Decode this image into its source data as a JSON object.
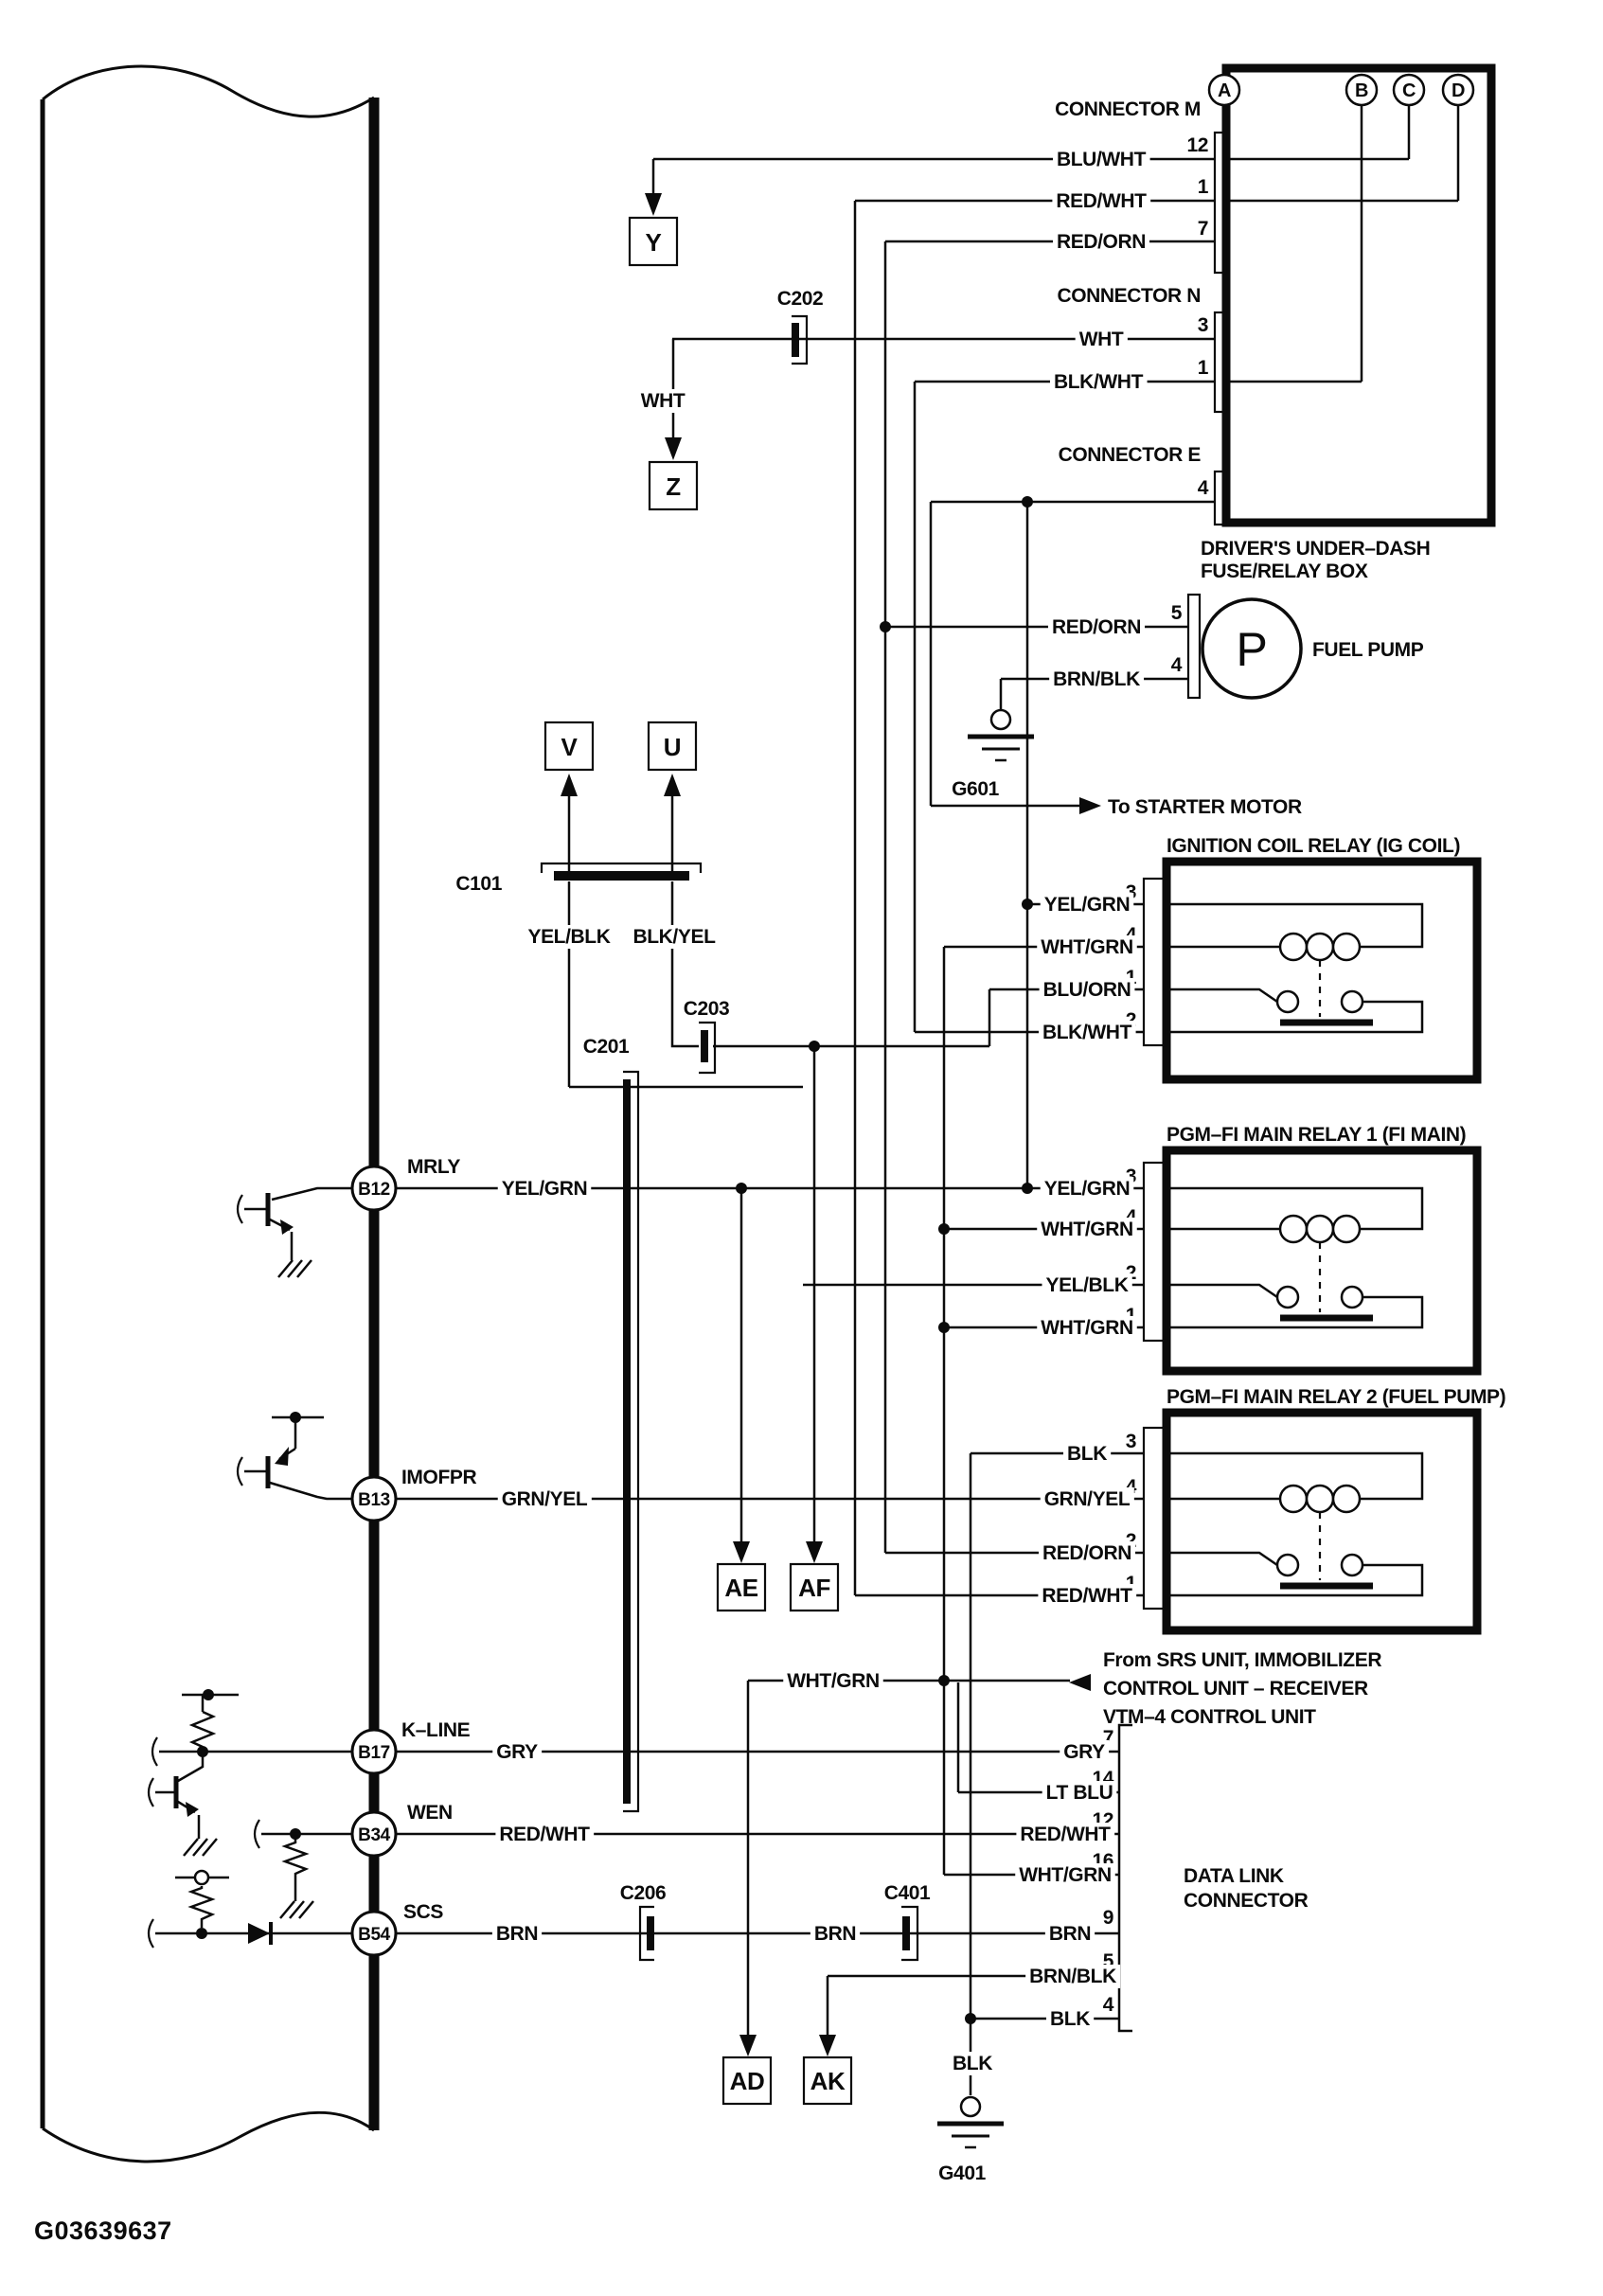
{
  "diagram": {
    "figure_id": "G03639637",
    "ref_circles": [
      "A",
      "B",
      "C",
      "D"
    ],
    "page_refs": {
      "y": "Y",
      "z": "Z",
      "v": "V",
      "u": "U",
      "ae": "AE",
      "af": "AF",
      "ad": "AD",
      "ak": "AK"
    },
    "inline_connectors": {
      "c101": "C101",
      "c201": "C201",
      "c202": "C202",
      "c203": "C203",
      "c206": "C206",
      "c401": "C401"
    },
    "grounds": {
      "g601": "G601",
      "g401": "G401"
    },
    "notes": {
      "starter": "To STARTER MOTOR",
      "srs_line1": "From SRS UNIT, IMMOBILIZER",
      "srs_line2": "CONTROL UNIT – RECEIVER",
      "srs_line3": "VTM–4 CONTROL UNIT"
    },
    "fuse_box": {
      "title_line1": "DRIVER'S UNDER–DASH",
      "title_line2": "FUSE/RELAY BOX",
      "connector_m": "CONNECTOR M",
      "connector_n": "CONNECTOR N",
      "connector_e": "CONNECTOR E",
      "m": [
        {
          "pin": "12",
          "wire": "BLU/WHT"
        },
        {
          "pin": "1",
          "wire": "RED/WHT"
        },
        {
          "pin": "7",
          "wire": "RED/ORN"
        }
      ],
      "n": [
        {
          "pin": "3",
          "wire": "WHT"
        },
        {
          "pin": "1",
          "wire": "BLK/WHT"
        }
      ],
      "e": [
        {
          "pin": "4"
        }
      ]
    },
    "fuel_pump": {
      "label": "FUEL PUMP",
      "symbol": "P",
      "pins": [
        {
          "pin": "5",
          "wire": "RED/ORN"
        },
        {
          "pin": "4",
          "wire": "BRN/BLK"
        }
      ]
    },
    "relays": [
      {
        "title": "IGNITION COIL RELAY (IG COIL)",
        "pins": [
          {
            "pin": "3",
            "wire": "YEL/GRN"
          },
          {
            "pin": "4",
            "wire": "WHT/GRN"
          },
          {
            "pin": "1",
            "wire": "BLU/ORN"
          },
          {
            "pin": "2",
            "wire": "BLK/WHT"
          }
        ]
      },
      {
        "title": "PGM–FI MAIN RELAY 1 (FI MAIN)",
        "pins": [
          {
            "pin": "3",
            "wire": "YEL/GRN"
          },
          {
            "pin": "4",
            "wire": "WHT/GRN"
          },
          {
            "pin": "2",
            "wire": "YEL/BLK"
          },
          {
            "pin": "1",
            "wire": "WHT/GRN"
          }
        ]
      },
      {
        "title": "PGM–FI MAIN RELAY 2 (FUEL PUMP)",
        "pins": [
          {
            "pin": "3",
            "wire": "BLK"
          },
          {
            "pin": "4",
            "wire": "GRN/YEL"
          },
          {
            "pin": "2",
            "wire": "RED/ORN"
          },
          {
            "pin": "1",
            "wire": "RED/WHT"
          }
        ]
      }
    ],
    "ecm_pins": [
      {
        "id": "B12",
        "name": "MRLY",
        "wire": "YEL/GRN"
      },
      {
        "id": "B13",
        "name": "IMOFPR",
        "wire": "GRN/YEL"
      },
      {
        "id": "B17",
        "name": "K–LINE",
        "wire": "GRY"
      },
      {
        "id": "B34",
        "name": "WEN",
        "wire": "RED/WHT"
      },
      {
        "id": "B54",
        "name": "SCS",
        "wire": "BRN"
      }
    ],
    "data_link": {
      "title_line1": "DATA LINK",
      "title_line2": "CONNECTOR",
      "pins": [
        {
          "pin": "7",
          "wire": "GRY"
        },
        {
          "pin": "14",
          "wire": "LT BLU"
        },
        {
          "pin": "12",
          "wire": "RED/WHT"
        },
        {
          "pin": "16",
          "wire": "WHT/GRN"
        },
        {
          "pin": "9",
          "wire": "BRN"
        },
        {
          "pin": "5",
          "wire": "BRN/BLK"
        },
        {
          "pin": "4",
          "wire": "BLK"
        }
      ]
    },
    "misc": {
      "wht": "WHT",
      "yel_blk": "YEL/BLK",
      "blk_yel": "BLK/YEL",
      "wht_grn": "WHT/GRN",
      "brn_mid": "BRN",
      "blk_vert": "BLK"
    }
  }
}
